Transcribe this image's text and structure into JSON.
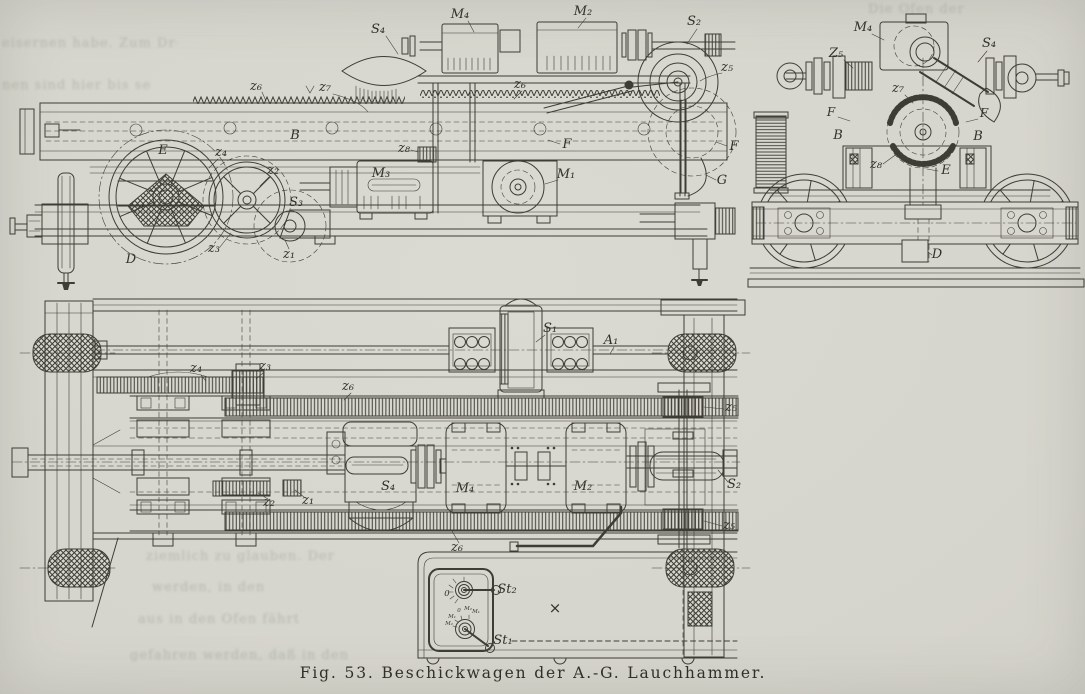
{
  "figure": {
    "caption": "Fig. 53.  Beschickwagen der A.-G. Lauchhammer."
  },
  "labels": {
    "side": {
      "s4": "S₄",
      "m4": "M₄",
      "m2": "M₂",
      "s2": "S₂",
      "z5": "z₅",
      "z6": "z₆",
      "z7": "z₇",
      "z8": "z₈",
      "b": "B",
      "e": "E",
      "z4": "z₄",
      "z2": "z₂",
      "z3": "z₃",
      "z1": "z₁",
      "s3": "S₃",
      "m3": "M₃",
      "m1": "M₁",
      "f": "F",
      "g": "G",
      "d": "D"
    },
    "end": {
      "m4": "M₄",
      "s4": "S₄",
      "z5": "Z₅",
      "z7": "z₇",
      "f": "F",
      "b": "B",
      "z8": "z₈",
      "e": "E",
      "d": "D"
    },
    "plan": {
      "z4": "z₄",
      "z3": "z₃",
      "z6": "z₆",
      "z5": "z₅",
      "s1": "S₁",
      "a1": "A₁",
      "s4": "S₄",
      "m4": "M₄",
      "m2": "M₂",
      "s2": "S₂",
      "z2": "z₂",
      "z1": "z₁",
      "x_mark": "×"
    },
    "controller": {
      "st1": "St₁",
      "st2": "St₂",
      "zero": "0",
      "m1": "M₁",
      "m2": "M₂"
    }
  },
  "print_through": {
    "fragments": [
      "eisernen habe. Zum Drehen des Sch",
      "nen sind hier bis sechs Mann",
      "Die Öfen der",
      "ziemlich zu glauben. Der",
      "werden, in den",
      "aus in den Ofen fährt",
      "gefahren werden, daß in den"
    ]
  }
}
